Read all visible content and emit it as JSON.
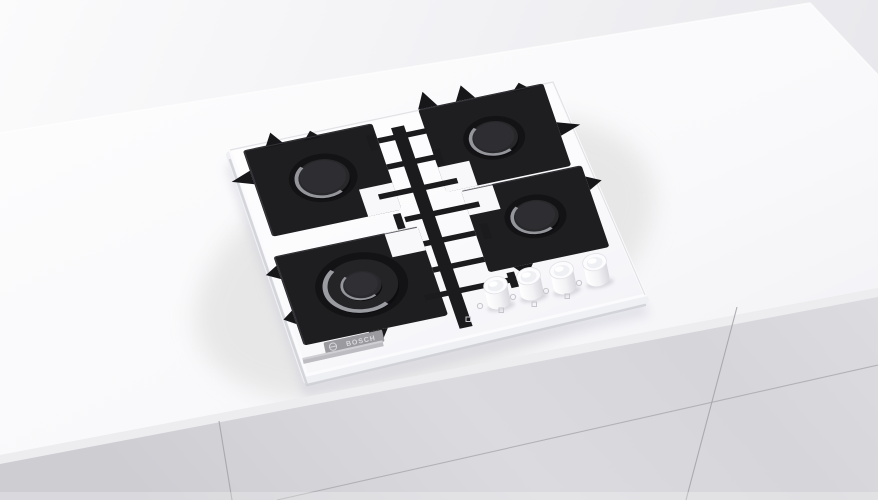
{
  "scene": {
    "type": "product-photo",
    "subject": "White built-in 4-burner gas hob with black cast-iron pan supports, installed in a white kitchen countertop over grey cabinet drawers",
    "brand": "BOSCH"
  },
  "hob": {
    "logo": {
      "text": "BOSCH",
      "symbol": "bosch-armature-icon",
      "badge_color": "#9a9a9f",
      "text_color": "#d9d9dc"
    },
    "glass_color": "#fafafc",
    "grate_color": "#1e1e21",
    "burner_count": 4,
    "burners": [
      {
        "position": "rear-left",
        "size": "standard",
        "cap_color": "#28282b"
      },
      {
        "position": "rear-right",
        "size": "standard",
        "cap_color": "#28282b"
      },
      {
        "position": "front-right",
        "size": "standard",
        "cap_color": "#28282b"
      },
      {
        "position": "front-left",
        "size": "wok-double-ring",
        "cap_color": "#242427"
      }
    ],
    "knobs": {
      "count": 4,
      "color": "#f6f6f9",
      "location": "front-right edge of glass"
    }
  },
  "environment": {
    "wall_color_left": "#f9f9fa",
    "wall_color_right": "#e9e9ed",
    "countertop_color": "#fbfbfd",
    "cabinet_color": "#d7d7db",
    "cabinet_seam_color": "#a2a2a7",
    "visible_cabinet_panels": 3
  }
}
